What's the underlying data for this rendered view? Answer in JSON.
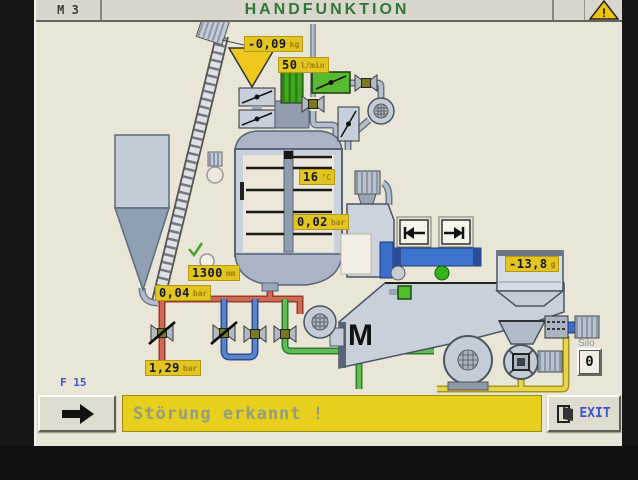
{
  "header": {
    "station": "M 3",
    "title": "HANDFUNKTION",
    "warning": "!"
  },
  "process": {
    "displays": {
      "dosing_weight": {
        "value": "-0,09",
        "unit": "kg"
      },
      "flow_rate": {
        "value": "50",
        "unit": "l/min"
      },
      "tank_temperature": {
        "value": "16",
        "unit": "°C"
      },
      "tank_pressure": {
        "value": "0,02",
        "unit": "bar"
      },
      "fill_level": {
        "value": "1300",
        "unit": "mm"
      },
      "supply_pressure": {
        "value": "0,04",
        "unit": "bar"
      },
      "line_pressure": {
        "value": "1,29",
        "unit": "bar"
      },
      "scale_weight": {
        "value": "-13,8",
        "unit": "g"
      },
      "silo_counter": "0"
    },
    "labels": {
      "silo": "Silo",
      "mill_motor": "M"
    }
  },
  "footer": {
    "page_code": "F 15",
    "alarm_message": "Störung erkannt !",
    "exit_label": "EXIT"
  },
  "colors": {
    "title_green": "#2f7839",
    "display_yellow": "#e2c51f",
    "alarm_yellow": "#e6cf1d",
    "pipe_red": "#cd6a57",
    "pipe_blue": "#5b82cc",
    "pipe_green": "#63bb58",
    "pipe_yellow": "#e6d44a"
  }
}
